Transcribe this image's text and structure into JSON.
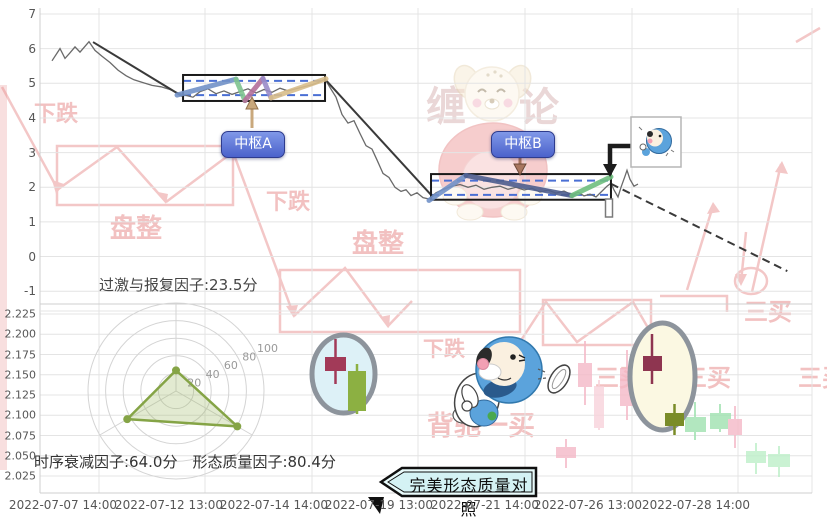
{
  "texts": {
    "pivot_a": "中枢A",
    "pivot_b": "中枢B",
    "factor_top": "过激与报复因子:23.5分",
    "factor_bottom_left": "时序衰减因子:64.0分",
    "factor_bottom_right": "形态质量因子:80.4分",
    "compare_label": "完美形态质量对照"
  },
  "axes": {
    "top_y": [
      "7",
      "6",
      "5",
      "4",
      "3",
      "2",
      "1",
      "0",
      "-1"
    ],
    "bottom_y": [
      "2.225",
      "2.200",
      "2.175",
      "2.150",
      "2.125",
      "2.100",
      "2.075",
      "2.050",
      "2.025"
    ],
    "x": [
      "2022-07-07 14:00",
      "2022-07-12 13:00",
      "2022-07-14 14:00",
      "2022-07-19 13:00",
      "2022-07-21 14:00",
      "2022-07-26 13:00",
      "2022-07-28 14:00"
    ],
    "x_centers": [
      63,
      169,
      274,
      379,
      485,
      588,
      696
    ],
    "grid_x": [
      99,
      205,
      312,
      418,
      525,
      632,
      738
    ]
  },
  "chart_data": {
    "type": "line",
    "title": "",
    "x_ticks": [
      "2022-07-07 14:00",
      "2022-07-12 13:00",
      "2022-07-14 14:00",
      "2022-07-19 13:00",
      "2022-07-21 14:00",
      "2022-07-26 13:00",
      "2022-07-28 14:00"
    ],
    "panels": {
      "price": {
        "ylim": [
          -1,
          7
        ],
        "y_ticks": [
          7,
          6,
          5,
          4,
          3,
          2,
          1,
          0,
          -1
        ],
        "series": [
          [
            0.0155,
            5.65
          ],
          [
            0.0259,
            6.0
          ],
          [
            0.0324,
            5.72
          ],
          [
            0.0389,
            5.88
          ],
          [
            0.0453,
            6.05
          ],
          [
            0.0518,
            5.9
          ],
          [
            0.0635,
            6.2
          ],
          [
            0.0712,
            5.95
          ],
          [
            0.0803,
            5.78
          ],
          [
            0.0907,
            5.6
          ],
          [
            0.101,
            5.38
          ],
          [
            0.1114,
            5.22
          ],
          [
            0.1218,
            5.1
          ],
          [
            0.1334,
            5.02
          ],
          [
            0.1451,
            4.94
          ],
          [
            0.1567,
            4.9
          ],
          [
            0.1684,
            4.82
          ],
          [
            0.1788,
            4.72
          ],
          [
            0.1891,
            4.65
          ],
          [
            0.1982,
            4.6
          ],
          [
            0.2073,
            4.76
          ],
          [
            0.2176,
            4.84
          ],
          [
            0.228,
            4.7
          ],
          [
            0.2383,
            4.78
          ],
          [
            0.2487,
            4.68
          ],
          [
            0.259,
            4.76
          ],
          [
            0.2694,
            4.84
          ],
          [
            0.2798,
            4.72
          ],
          [
            0.2902,
            4.82
          ],
          [
            0.3005,
            4.74
          ],
          [
            0.3109,
            4.86
          ],
          [
            0.3212,
            4.78
          ],
          [
            0.3316,
            4.84
          ],
          [
            0.342,
            4.9
          ],
          [
            0.3523,
            4.96
          ],
          [
            0.3601,
            5.02
          ],
          [
            0.3692,
            5.12
          ],
          [
            0.3756,
            4.88
          ],
          [
            0.3834,
            4.6
          ],
          [
            0.3912,
            4.1
          ],
          [
            0.399,
            3.85
          ],
          [
            0.4067,
            3.92
          ],
          [
            0.4145,
            3.55
          ],
          [
            0.4223,
            3.2
          ],
          [
            0.4301,
            3.1
          ],
          [
            0.4366,
            2.78
          ],
          [
            0.4443,
            2.4
          ],
          [
            0.4521,
            2.28
          ],
          [
            0.4599,
            2.0
          ],
          [
            0.4676,
            1.88
          ],
          [
            0.4741,
            1.93
          ],
          [
            0.4806,
            1.76
          ],
          [
            0.4883,
            1.84
          ],
          [
            0.4961,
            1.7
          ],
          [
            0.5039,
            1.66
          ],
          [
            0.513,
            1.84
          ],
          [
            0.5233,
            1.95
          ],
          [
            0.5337,
            2.03
          ],
          [
            0.544,
            2.08
          ],
          [
            0.5544,
            2.0
          ],
          [
            0.5648,
            2.06
          ],
          [
            0.5751,
            1.94
          ],
          [
            0.5855,
            2.0
          ],
          [
            0.5959,
            2.03
          ],
          [
            0.6062,
            1.94
          ],
          [
            0.6166,
            2.0
          ],
          [
            0.627,
            1.92
          ],
          [
            0.6373,
            1.97
          ],
          [
            0.6477,
            1.86
          ],
          [
            0.658,
            1.92
          ],
          [
            0.6684,
            1.83
          ],
          [
            0.6788,
            1.89
          ],
          [
            0.6891,
            1.78
          ],
          [
            0.6969,
            1.86
          ],
          [
            0.7047,
            1.75
          ],
          [
            0.7124,
            1.8
          ],
          [
            0.7202,
            1.72
          ],
          [
            0.728,
            1.89
          ],
          [
            0.7345,
            2.03
          ],
          [
            0.7396,
            2.12
          ],
          [
            0.7435,
            1.92
          ],
          [
            0.7487,
            1.72
          ],
          [
            0.7526,
            2.0
          ],
          [
            0.7578,
            2.32
          ],
          [
            0.7604,
            2.49
          ],
          [
            0.7642,
            2.23
          ],
          [
            0.7694,
            2.03
          ],
          [
            0.7746,
            2.09
          ]
        ],
        "trend_lines": [
          {
            "from": [
              0.0687,
              6.19
            ],
            "to": [
              0.1839,
              4.63
            ],
            "dash": false
          },
          {
            "from": [
              0.3692,
              5.12
            ],
            "to": [
              0.509,
              1.72
            ],
            "dash": false
          },
          {
            "from": [
              0.7396,
              2.1
            ],
            "to": [
              0.968,
              -0.42
            ],
            "dash": true
          }
        ],
        "pivots": [
          {
            "label": "中枢A",
            "x_range": [
              0.1853,
              0.3692
            ],
            "v_range": [
              4.49,
              5.24
            ],
            "dashed_levels": [
              4.66,
              5.07
            ],
            "segments": [
              {
                "color": "#7292c8",
                "pts": [
                  [
                    0.1775,
                    4.66
                  ],
                  [
                    0.2539,
                    5.12
                  ]
                ]
              },
              {
                "color": "#7fc48f",
                "pts": [
                  [
                    0.2539,
                    5.12
                  ],
                  [
                    0.2655,
                    4.5
                  ]
                ]
              },
              {
                "color": "#b4709a",
                "pts": [
                  [
                    0.2655,
                    4.5
                  ],
                  [
                    0.2888,
                    5.14
                  ]
                ]
              },
              {
                "color": "#9a8cc8",
                "pts": [
                  [
                    0.2888,
                    5.14
                  ],
                  [
                    0.2992,
                    4.58
                  ]
                ]
              },
              {
                "color": "#d8bd8a",
                "pts": [
                  [
                    0.2992,
                    4.58
                  ],
                  [
                    0.3705,
                    5.13
                  ]
                ]
              }
            ]
          },
          {
            "label": "中枢B",
            "x_range": [
              0.5065,
              0.7396
            ],
            "v_range": [
              1.64,
              2.38
            ],
            "dashed_levels": [
              1.78,
              2.19
            ],
            "segments": [
              {
                "color": "#7292c8",
                "pts": [
                  [
                    0.5039,
                    1.62
                  ],
                  [
                    0.5518,
                    2.34
                  ]
                ]
              },
              {
                "color": "#4e5e8e",
                "pts": [
                  [
                    0.5518,
                    2.34
                  ],
                  [
                    0.6891,
                    1.76
                  ]
                ]
              },
              {
                "color": "#6fbf7f",
                "pts": [
                  [
                    0.6891,
                    1.76
                  ],
                  [
                    0.7396,
                    2.3
                  ]
                ]
              }
            ]
          }
        ]
      },
      "compare": {
        "y_ticks": [
          2.225,
          2.2,
          2.175,
          2.15,
          2.125,
          2.1,
          2.075,
          2.05,
          2.025
        ]
      }
    },
    "radar": {
      "max": 100,
      "ring_step": 20,
      "ring_labels": [
        "20",
        "40",
        "60",
        "80",
        "100"
      ],
      "indicators": [
        {
          "name": "过激与报复因子",
          "value": 23.5
        },
        {
          "name": "时序衰减因子",
          "value": 64.0
        },
        {
          "name": "形态质量因子",
          "value": 80.4
        }
      ]
    }
  },
  "comparison_icons": [
    {
      "shape": "circle",
      "cx": 343.5,
      "cy": 374,
      "rx": 31.5,
      "ry": 39,
      "fill": "#ddf1f7",
      "ring": "#8d949c",
      "candles": [
        {
          "x": 325,
          "y": 357,
          "w": 21,
          "h": 14,
          "color": "#a23a58",
          "wx": 335.5,
          "w1": 339,
          "w2": 384
        },
        {
          "x": 348,
          "y": 371,
          "w": 18,
          "h": 40,
          "color": "#8cb042",
          "wx": 357,
          "w1": 364,
          "w2": 414
        }
      ]
    },
    {
      "shape": "ellipse",
      "cx": 662.5,
      "cy": 376.5,
      "rx": 32.5,
      "ry": 53.5,
      "fill": "#fbf8e2",
      "ring": "#8d949c",
      "candles": [
        {
          "x": 643,
          "y": 356,
          "w": 19,
          "h": 15,
          "color": "#8e3550",
          "wx": 652,
          "w1": 334,
          "w2": 384
        },
        {
          "x": 665,
          "y": 413,
          "w": 19,
          "h": 13,
          "color": "#7a8c28",
          "wx": 674.5,
          "w1": 404,
          "w2": 435
        }
      ]
    }
  ],
  "background_candles": [
    {
      "x": 578,
      "y": 363,
      "w": 14,
      "h": 24,
      "c": "#f5b9c7",
      "wx": 585,
      "w1": 341,
      "w2": 405
    },
    {
      "x": 594,
      "y": 386,
      "w": 10,
      "h": 42,
      "c": "#f8d3db",
      "wx": 599,
      "w1": 380,
      "w2": 430
    },
    {
      "x": 620,
      "y": 368,
      "w": 14,
      "h": 38,
      "c": "#f5b9c7",
      "wx": 627,
      "w1": 350,
      "w2": 420
    },
    {
      "x": 556,
      "y": 447,
      "w": 20,
      "h": 11,
      "c": "#f5b9c7",
      "wx": 566,
      "w1": 439,
      "w2": 468
    },
    {
      "x": 685,
      "y": 417,
      "w": 21,
      "h": 15,
      "c": "#9fe2b0",
      "wx": 695,
      "w1": 402,
      "w2": 440
    },
    {
      "x": 710,
      "y": 413,
      "w": 21,
      "h": 16,
      "c": "#9fe2b0",
      "wx": 720,
      "w1": 404,
      "w2": 432
    },
    {
      "x": 728,
      "y": 419,
      "w": 14,
      "h": 16,
      "c": "#f5b9c7",
      "wx": 735,
      "w1": 406,
      "w2": 448
    },
    {
      "x": 746,
      "y": 451,
      "w": 20,
      "h": 12,
      "c": "#bdefc9",
      "wx": 756,
      "w1": 443,
      "w2": 474
    },
    {
      "x": 768,
      "y": 454,
      "w": 22,
      "h": 13,
      "c": "#bdefc9",
      "wx": 779,
      "w1": 446,
      "w2": 477
    }
  ],
  "watermarks": {
    "brand": [
      {
        "t": "缠",
        "x": 446,
        "y": 120,
        "s": 40
      },
      {
        "t": "论",
        "x": 539,
        "y": 121,
        "s": 40
      }
    ],
    "texts": [
      {
        "t": "下跌",
        "x": 56,
        "y": 121,
        "s": 22
      },
      {
        "t": "下跌",
        "x": 288,
        "y": 209,
        "s": 22
      },
      {
        "t": "下跌",
        "x": 444,
        "y": 356,
        "s": 21
      },
      {
        "t": "盘整",
        "x": 136,
        "y": 237,
        "s": 26
      },
      {
        "t": "盘整",
        "x": 378,
        "y": 252,
        "s": 26
      },
      {
        "t": "三买",
        "x": 768,
        "y": 320,
        "s": 24
      },
      {
        "t": "三买",
        "x": 619,
        "y": 386,
        "s": 24
      },
      {
        "t": "三买",
        "x": 707,
        "y": 386,
        "s": 24
      },
      {
        "t": "三买",
        "x": 822,
        "y": 386,
        "s": 24
      },
      {
        "t": "背驰一买",
        "x": 481,
        "y": 435,
        "s": 27
      }
    ],
    "lines": [
      "2,87 57,188",
      "57,190 117,147 166,202",
      "166,202 233,152 294,316",
      "294,316 345,268 388,326 412,301",
      "518,345 546,302 577,342 633,302 658,345",
      "687,290 713,206",
      "752,292 781,164",
      "746,232 741,282",
      "796,42 820,28"
    ],
    "rects": [
      [
        57,
        146,
        176,
        59
      ],
      [
        280,
        270,
        240,
        62
      ],
      [
        543,
        300,
        108,
        45
      ]
    ],
    "corner": "660,296 727,296 727,312",
    "ellipse": [
      751,
      281,
      16,
      13
    ],
    "arrowheads": [
      "52,180 64,184 56,194",
      "158,192 168,194 166,204",
      "286,306 298,305 294,318",
      "380,317 390,315 389,328",
      "707,214 720,212 713,202",
      "775,172 788,174 782,161",
      "735,274 747,274 741,286"
    ]
  },
  "colors": {
    "grid": "#e4e4e4",
    "border": "#cfcfcf",
    "price_line": "#6a6a6a",
    "trend_line": "#3a3a3a",
    "box_stroke": "#1a1a1a",
    "box_dashed": "#4a6fd4",
    "radar_ring": "#d4d4d4",
    "radar_poly": "#85a446",
    "watermark_red": "#e89090",
    "leader_black": "#1c1c1c",
    "arrow_a": "#c9a87c",
    "arrow_b": "#a8765f",
    "compare_fill": "#e9fbfb",
    "doraemon_blue": "#5ba3dc"
  }
}
